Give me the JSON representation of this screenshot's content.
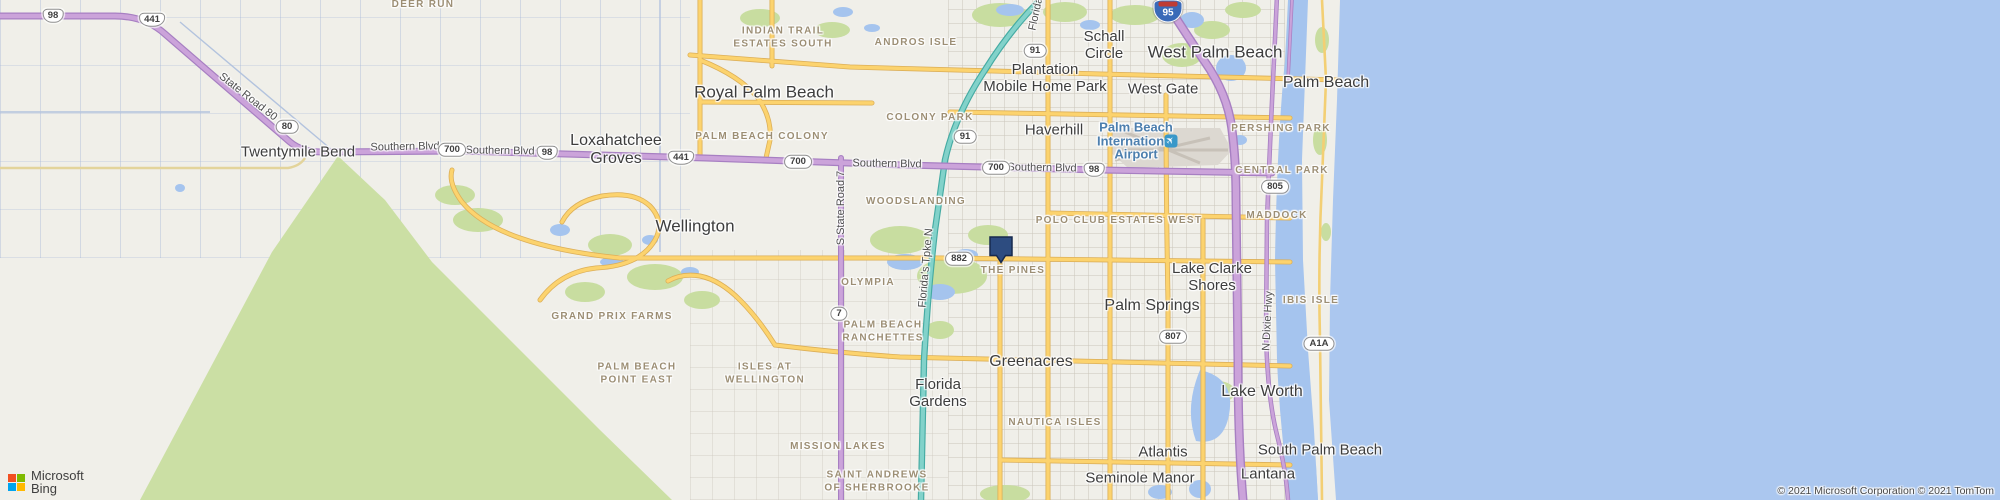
{
  "map": {
    "marker": {
      "x": 1001,
      "y": 249
    },
    "airport": {
      "name": "Palm Beach\nInternational\nAirport",
      "icon_glyph": "✈",
      "x": 1136,
      "y": 141,
      "icon_x": 1171,
      "icon_y": 141
    },
    "labels": {
      "cities": [
        {
          "t": "Twentymile Bend",
          "x": 298,
          "y": 153,
          "s": 15
        },
        {
          "t": "Loxahatchee\nGroves",
          "x": 616,
          "y": 150,
          "s": 16
        },
        {
          "t": "Royal Palm Beach",
          "x": 764,
          "y": 92,
          "s": 17
        },
        {
          "t": "Wellington",
          "x": 695,
          "y": 226,
          "s": 17
        },
        {
          "t": "Schall\nCircle",
          "x": 1104,
          "y": 46,
          "s": 15
        },
        {
          "t": "West Palm Beach",
          "x": 1215,
          "y": 52,
          "s": 17
        },
        {
          "t": "Palm Beach",
          "x": 1326,
          "y": 83,
          "s": 16
        },
        {
          "t": "Plantation\nMobile Home Park",
          "x": 1045,
          "y": 79,
          "s": 15
        },
        {
          "t": "West Gate",
          "x": 1163,
          "y": 90,
          "s": 15
        },
        {
          "t": "Haverhill",
          "x": 1054,
          "y": 131,
          "s": 15
        },
        {
          "t": "Palm Springs",
          "x": 1152,
          "y": 306,
          "s": 16
        },
        {
          "t": "Lake Clarke\nShores",
          "x": 1212,
          "y": 278,
          "s": 15
        },
        {
          "t": "Greenacres",
          "x": 1031,
          "y": 362,
          "s": 16
        },
        {
          "t": "Lake Worth",
          "x": 1262,
          "y": 392,
          "s": 16
        },
        {
          "t": "Florida\nGardens",
          "x": 938,
          "y": 394,
          "s": 15
        },
        {
          "t": "Atlantis",
          "x": 1163,
          "y": 453,
          "s": 15
        },
        {
          "t": "Seminole Manor",
          "x": 1140,
          "y": 479,
          "s": 15
        },
        {
          "t": "Lantana",
          "x": 1268,
          "y": 475,
          "s": 15
        },
        {
          "t": "South Palm Beach",
          "x": 1320,
          "y": 451,
          "s": 15
        }
      ],
      "neighborhoods": [
        {
          "t": "DEER RUN",
          "x": 423,
          "y": 5
        },
        {
          "t": "INDIAN TRAIL\nESTATES SOUTH",
          "x": 783,
          "y": 38
        },
        {
          "t": "ANDROS ISLE",
          "x": 916,
          "y": 43
        },
        {
          "t": "COLONY PARK",
          "x": 930,
          "y": 118
        },
        {
          "t": "PALM BEACH COLONY",
          "x": 762,
          "y": 137
        },
        {
          "t": "WOODSLANDING",
          "x": 916,
          "y": 202
        },
        {
          "t": "POLO CLUB ESTATES WEST",
          "x": 1119,
          "y": 221
        },
        {
          "t": "PERSHING PARK",
          "x": 1281,
          "y": 129
        },
        {
          "t": "CENTRAL PARK",
          "x": 1282,
          "y": 171
        },
        {
          "t": "MADDOCK",
          "x": 1277,
          "y": 216
        },
        {
          "t": "OLYMPIA",
          "x": 868,
          "y": 283
        },
        {
          "t": "GRAND PRIX FARMS",
          "x": 612,
          "y": 317
        },
        {
          "t": "PALM BEACH\nRANCHETTES",
          "x": 883,
          "y": 332
        },
        {
          "t": "PALM BEACH\nPOINT EAST",
          "x": 637,
          "y": 374
        },
        {
          "t": "ISLES AT\nWELLINGTON",
          "x": 765,
          "y": 374
        },
        {
          "t": "MISSION LAKES",
          "x": 838,
          "y": 447
        },
        {
          "t": "SAINT ANDREWS\nOF SHERBROOKE",
          "x": 877,
          "y": 482
        },
        {
          "t": "NAUTICA ISLES",
          "x": 1055,
          "y": 423
        },
        {
          "t": "IBIS ISLE",
          "x": 1311,
          "y": 301
        },
        {
          "t": "THE PINES",
          "x": 1013,
          "y": 271
        }
      ],
      "roads": [
        {
          "t": "Southern Blvd",
          "x": 405,
          "y": 147,
          "r": -1
        },
        {
          "t": "Southern Blvd",
          "x": 500,
          "y": 151,
          "r": 1
        },
        {
          "t": "Southern Blvd",
          "x": 887,
          "y": 164,
          "r": 1
        },
        {
          "t": "Southern Blvd",
          "x": 1042,
          "y": 168,
          "r": 1
        },
        {
          "t": "State Road 80",
          "x": 248,
          "y": 97,
          "r": 38
        },
        {
          "t": "S State Road 7",
          "x": 841,
          "y": 208,
          "r": -90
        },
        {
          "t": "Florida's Tpke N",
          "x": 926,
          "y": 268,
          "r": -85
        },
        {
          "t": "Florida",
          "x": 1036,
          "y": 14,
          "r": -78
        },
        {
          "t": "N Dixie Hwy",
          "x": 1268,
          "y": 321,
          "r": -87
        }
      ],
      "shields": [
        {
          "k": "us",
          "t": "98",
          "x": 53,
          "y": 16
        },
        {
          "k": "us",
          "t": "441",
          "x": 152,
          "y": 20
        },
        {
          "k": "st",
          "t": "80",
          "x": 287,
          "y": 127
        },
        {
          "k": "st",
          "t": "700",
          "x": 452,
          "y": 150
        },
        {
          "k": "us",
          "t": "98",
          "x": 547,
          "y": 153
        },
        {
          "k": "us",
          "t": "441",
          "x": 681,
          "y": 158
        },
        {
          "k": "st",
          "t": "700",
          "x": 798,
          "y": 162
        },
        {
          "k": "st",
          "t": "91",
          "x": 965,
          "y": 137
        },
        {
          "k": "st",
          "t": "91",
          "x": 1035,
          "y": 51
        },
        {
          "k": "i95",
          "t": "95",
          "x": 1168,
          "y": 11
        },
        {
          "k": "st",
          "t": "700",
          "x": 996,
          "y": 168
        },
        {
          "k": "us",
          "t": "98",
          "x": 1094,
          "y": 170
        },
        {
          "k": "st",
          "t": "805",
          "x": 1275,
          "y": 187
        },
        {
          "k": "st",
          "t": "882",
          "x": 959,
          "y": 259
        },
        {
          "k": "st",
          "t": "7",
          "x": 839,
          "y": 314
        },
        {
          "k": "st",
          "t": "807",
          "x": 1173,
          "y": 337
        },
        {
          "k": "st",
          "t": "A1A",
          "x": 1319,
          "y": 344
        }
      ]
    },
    "attribution": {
      "brand_line1": "Microsoft",
      "brand_line2": "Bing",
      "copyright": "© 2021 Microsoft Corporation © 2021 TomTom"
    },
    "colors": {
      "ocean": "#abc7ef",
      "lagoon": "#a5c4ee",
      "land": "#f0efe9",
      "green": "#cbdfa4",
      "road_yellow": "#fcd36e",
      "road_purple": "#cba3da",
      "road_teal": "#82d2ca",
      "marker_fill": "#2d4c80"
    }
  }
}
